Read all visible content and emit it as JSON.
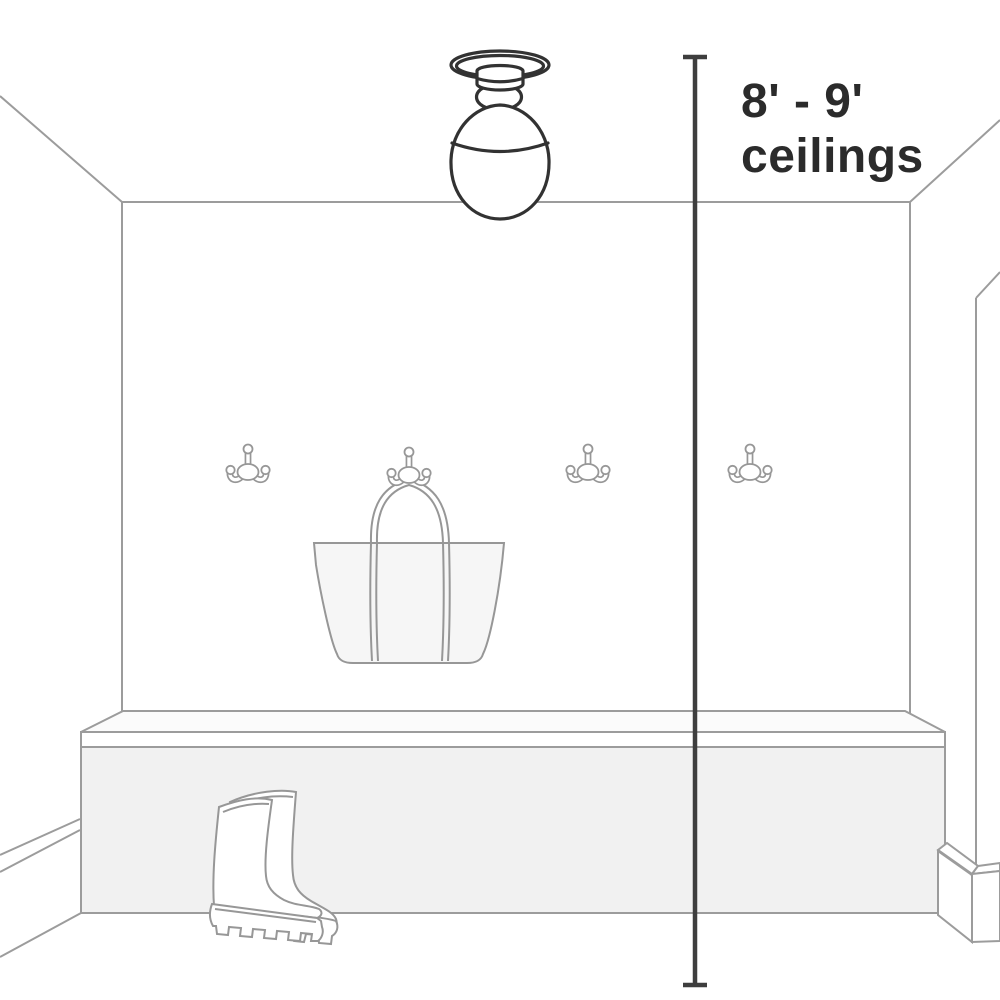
{
  "diagram": {
    "type": "product-scale-illustration",
    "subject": "semi-flush ceiling light shown in a mudroom entryway",
    "dimension_label": {
      "line1": "8' - 9'",
      "line2": "ceilings"
    },
    "colors": {
      "background": "#ffffff",
      "room_lines": "#9c9c9c",
      "object_lines": "#979797",
      "fill_faint": "#fbfbfb",
      "fill_light": "#f6f6f6",
      "fill_medium": "#f1f1f1",
      "fixture_lines": "#323232",
      "dimension_line": "#3e3e3e",
      "label_text": "#2b2b2b"
    },
    "objects": [
      {
        "name": "ceiling-light-icon",
        "meaning": "semi-flush mount light with globe shade"
      },
      {
        "name": "dimension-line",
        "meaning": "floor-to-ceiling height measurement"
      },
      {
        "name": "coat-hook-icon",
        "count": 4,
        "meaning": "double-prong wall hooks"
      },
      {
        "name": "tote-bag-icon",
        "meaning": "tote bag hanging from second hook"
      },
      {
        "name": "bench",
        "meaning": "built-in mudroom bench"
      },
      {
        "name": "rain-boots-icon",
        "meaning": "pair of rain boots on floor"
      }
    ]
  }
}
